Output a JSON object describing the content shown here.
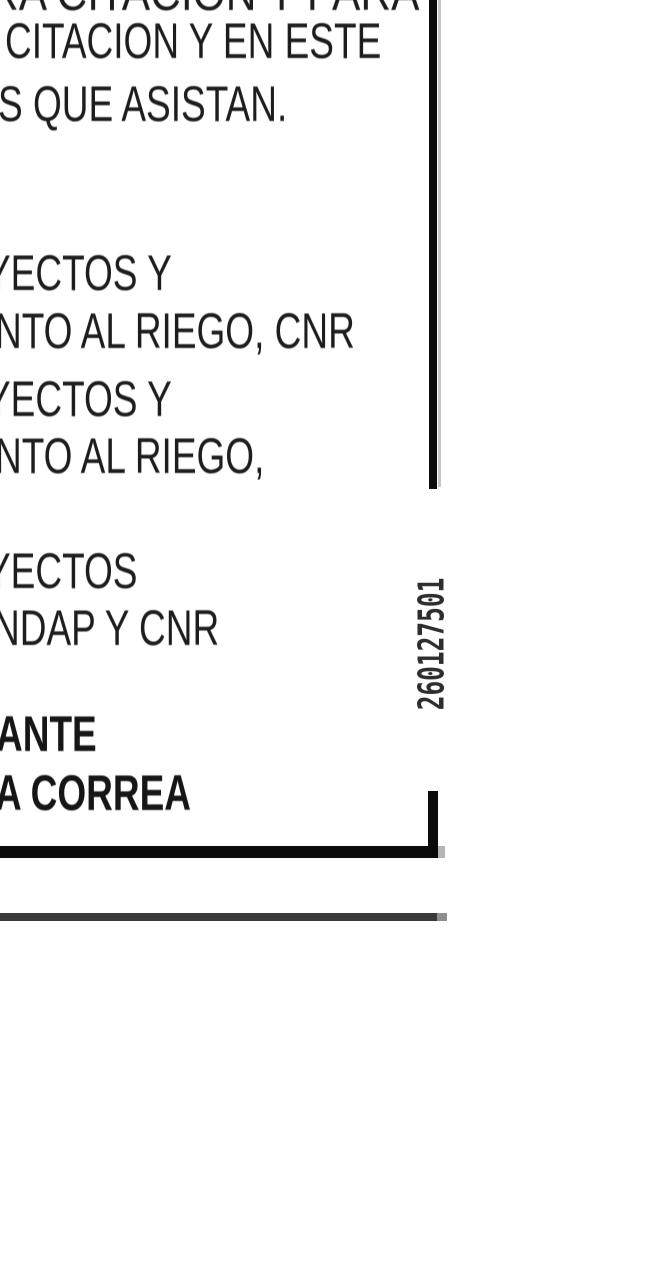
{
  "page": {
    "background": "#ffffff",
    "text_color": "#222222",
    "bold_text_color": "#1b1b1b",
    "border_color": "#0b0b0b",
    "thin_rule_color": "#3a3a3a",
    "stamp_color": "#2e2e2e"
  },
  "document": {
    "top_block": {
      "line1": "RA CITACION Y PARA",
      "line2": "CITACION Y EN ESTE",
      "line3": "S QUE ASISTAN."
    },
    "middle_block": {
      "line1": "YECTOS Y",
      "line2": "NTO AL RIEGO, CNR",
      "line3": "YECTOS Y",
      "line4": "NTO AL RIEGO,"
    },
    "lower_block": {
      "line1": "YECTOS",
      "line2": "NDAP Y CNR"
    },
    "signature_block": {
      "line1": "ANTE",
      "line2": "A CORREA"
    },
    "stamp": {
      "number": "260127501"
    }
  }
}
